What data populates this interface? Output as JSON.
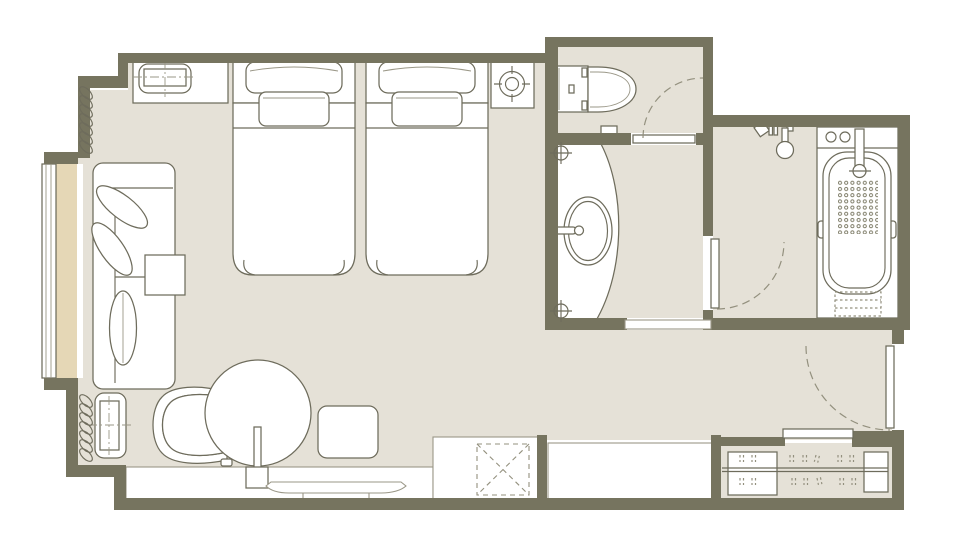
{
  "meta": {
    "kind": "hotel-guestroom-floor-plan",
    "width_px": 960,
    "height_px": 546,
    "visible_text": "none"
  },
  "colors": {
    "wall": "#76745f",
    "floor": "#e5e1d7",
    "bay": "#e5d7b6",
    "line": "#6e6c5c",
    "line_light": "#9a9787",
    "arc": "#93907e",
    "white": "#ffffff"
  },
  "rooms": [
    {
      "id": "bedroom",
      "label": "bedroom / sitting area"
    },
    {
      "id": "toilet-room",
      "label": "toilet room"
    },
    {
      "id": "vanity-room",
      "label": "washbasin room"
    },
    {
      "id": "bathroom",
      "label": "bathroom with tub and shower"
    },
    {
      "id": "entry-hall",
      "label": "entry corridor"
    },
    {
      "id": "wardrobe",
      "label": "wardrobe / closet"
    }
  ],
  "furniture": [
    {
      "id": "bed-1",
      "label": "twin bed with two pillows"
    },
    {
      "id": "bed-2",
      "label": "twin bed with two pillows"
    },
    {
      "id": "nightstand",
      "label": "headboard console"
    },
    {
      "id": "ceiling-fixture",
      "label": "ceiling fixture symbol"
    },
    {
      "id": "sofa",
      "label": "sofa with cushions and bolster"
    },
    {
      "id": "side-table",
      "label": "square side table"
    },
    {
      "id": "console-2",
      "label": "low cabinet"
    },
    {
      "id": "armchair",
      "label": "armchair"
    },
    {
      "id": "round-table",
      "label": "round table"
    },
    {
      "id": "floor-stand",
      "label": "table pedestal / floor stand"
    },
    {
      "id": "ottoman",
      "label": "ottoman"
    },
    {
      "id": "tv",
      "label": "television on stand"
    },
    {
      "id": "tv-console",
      "label": "long low console"
    },
    {
      "id": "luggage-rack",
      "label": "luggage bench (crossed square)"
    },
    {
      "id": "desk",
      "label": "counter / desk"
    },
    {
      "id": "wardrobe-shelf-left",
      "label": "wardrobe shelf unit"
    },
    {
      "id": "wardrobe-shelf-right",
      "label": "wardrobe shelf unit"
    },
    {
      "id": "hanging-rod",
      "label": "wardrobe hanging rod"
    },
    {
      "id": "toilet",
      "label": "toilet"
    },
    {
      "id": "bath-mat",
      "label": "small mat / step"
    },
    {
      "id": "washbasin",
      "label": "curved vanity counter with oval basin"
    },
    {
      "id": "bathtub",
      "label": "bathtub with faucet and controls"
    },
    {
      "id": "shower-set",
      "label": "shower fixtures"
    },
    {
      "id": "curtain-upper",
      "label": "curtain coil symbol"
    },
    {
      "id": "curtain-lower",
      "label": "curtain coil symbol"
    },
    {
      "id": "window",
      "label": "window with glazing lines"
    }
  ],
  "doors": [
    {
      "id": "toilet-door",
      "label": "swing door, toilet room"
    },
    {
      "id": "bathroom-door",
      "label": "swing door, bathroom"
    },
    {
      "id": "entry-door",
      "label": "entry swing door (dashed)"
    },
    {
      "id": "vanity-opening",
      "label": "open threshold to corridor"
    },
    {
      "id": "wardrobe-opening",
      "label": "wardrobe sliding panel"
    }
  ]
}
